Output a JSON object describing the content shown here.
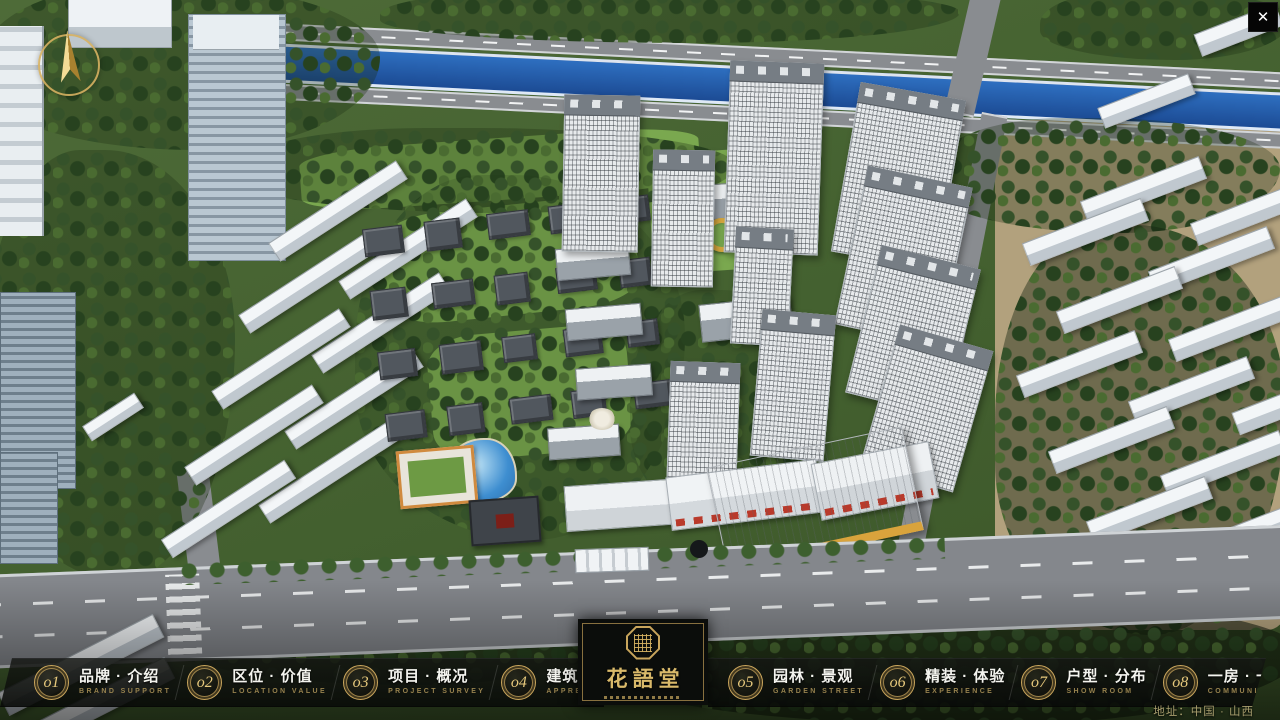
{
  "close_button": {
    "label": "✕"
  },
  "logo": {
    "title": "花語堂"
  },
  "nav": {
    "items": [
      {
        "num": "o1",
        "zh": "品牌 · 介绍",
        "en": "BRAND SUPPORT"
      },
      {
        "num": "o2",
        "zh": "区位 · 价值",
        "en": "LOCATION VALUE"
      },
      {
        "num": "o3",
        "zh": "项目 · 概况",
        "en": "PROJECT SURVEY"
      },
      {
        "num": "o4",
        "zh": "建筑 · 鉴赏",
        "en": "APPRECIATION"
      },
      {
        "num": "o5",
        "zh": "园林 · 景观",
        "en": "GARDEN STREET"
      },
      {
        "num": "o6",
        "zh": "精装 · 体验",
        "en": "EXPERIENCE"
      },
      {
        "num": "o7",
        "zh": "户型 · 分布",
        "en": "SHOW ROOM"
      },
      {
        "num": "o8",
        "zh": "一房 · 一景",
        "en": "COMMUNITY"
      }
    ]
  },
  "footer": {
    "address": "地址：中国 · 山西"
  },
  "colors": {
    "gold": "#C9A55C",
    "nav_bg": "rgba(10,12,10,0.82)",
    "river_blue": "#2257A8",
    "close_bg": "#000000"
  }
}
